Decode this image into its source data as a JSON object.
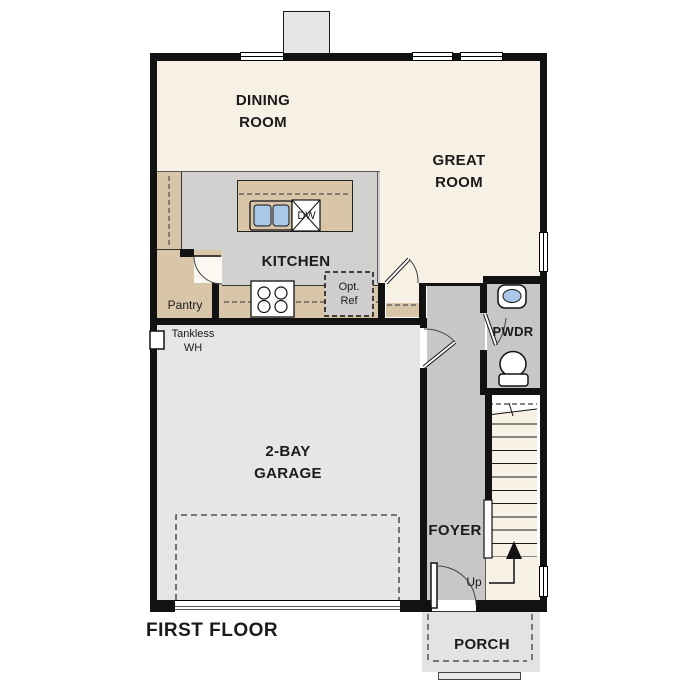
{
  "floor_plan": {
    "title": "FIRST FLOOR",
    "rooms": {
      "dining": "DINING ROOM",
      "great": "GREAT ROOM",
      "kitchen": "KITCHEN",
      "garage": "2-BAY GARAGE",
      "foyer": "FOYER",
      "powder": "PWDR",
      "porch": "PORCH",
      "pantry": "Pantry"
    },
    "labels": {
      "dishwasher": "DW",
      "optional_refrigerator": "Opt. Ref",
      "tankless_water_heater": "Tankless WH",
      "stairs_up": "Up"
    },
    "colors": {
      "wall": "#121212",
      "living_cream": "#f7f0e4",
      "kitchen_floor": "#d2d1d0",
      "hall_floor": "#c8c7c6",
      "counter_tan": "#d9c6a8",
      "garage_floor": "#e7e6e4",
      "porch": "#e4e3e1",
      "stair_tread": "#f8f1e5",
      "fixture_blue": "#a9c7e8"
    }
  }
}
